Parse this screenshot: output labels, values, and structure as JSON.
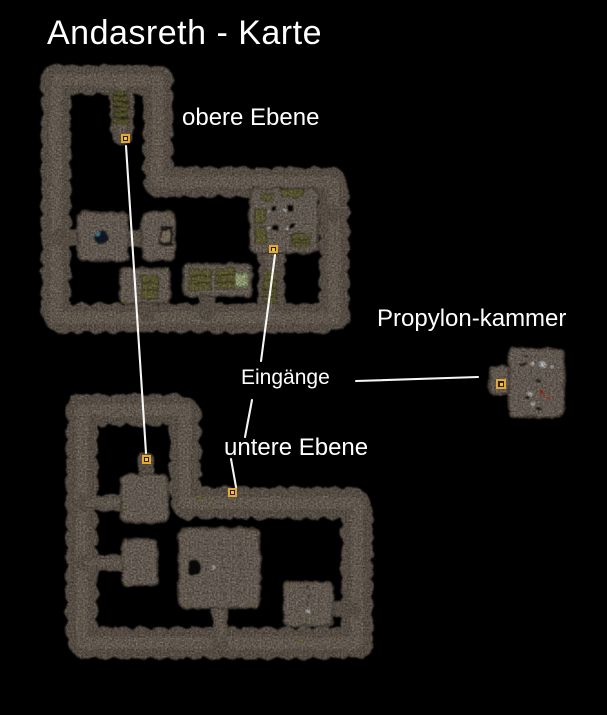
{
  "title": "Andasreth - Karte",
  "labels": {
    "upper_level": "obere Ebene",
    "lower_level": "untere Ebene",
    "propylon_chamber": "Propylon-kammer",
    "entrances": "Eingänge"
  },
  "maps": {
    "upper": {
      "label": "obere Ebene",
      "entrance_count": 2
    },
    "lower": {
      "label": "untere Ebene",
      "entrance_count": 2
    },
    "propylon": {
      "label": "Propylon-kammer",
      "entrance_count": 1
    }
  },
  "markers": [
    {
      "id": "entrance-marker-upper-north",
      "map": "upper",
      "x": 121,
      "y": 134,
      "w": 9,
      "h": 9
    },
    {
      "id": "entrance-marker-upper-south",
      "map": "upper",
      "x": 269,
      "y": 245,
      "w": 9,
      "h": 8
    },
    {
      "id": "entrance-marker-lower-west",
      "map": "lower",
      "x": 142,
      "y": 455,
      "w": 9,
      "h": 9
    },
    {
      "id": "entrance-marker-lower-shelf",
      "map": "lower",
      "x": 228,
      "y": 488,
      "w": 9,
      "h": 9
    },
    {
      "id": "entrance-marker-propylon",
      "map": "propylon",
      "x": 496,
      "y": 379,
      "w": 10,
      "h": 10
    }
  ],
  "colors": {
    "background": "#000000",
    "text": "#ffffff",
    "pointer_line": "#ffffff",
    "corridor": "#7c6f63",
    "corridor_highlight": "#968879",
    "room": "#8e8174",
    "room_edge": "#5f564c",
    "marker_border": "#e4a636",
    "marker_fill": "#2a2408",
    "marker_dot": "#e8c34a",
    "crate": "#817c48",
    "crate_bright": "#ccdca4",
    "pool": "#152230",
    "pool_glint": "#68a8c0",
    "dot_red": "#c23428",
    "dot_white": "#ededed"
  }
}
